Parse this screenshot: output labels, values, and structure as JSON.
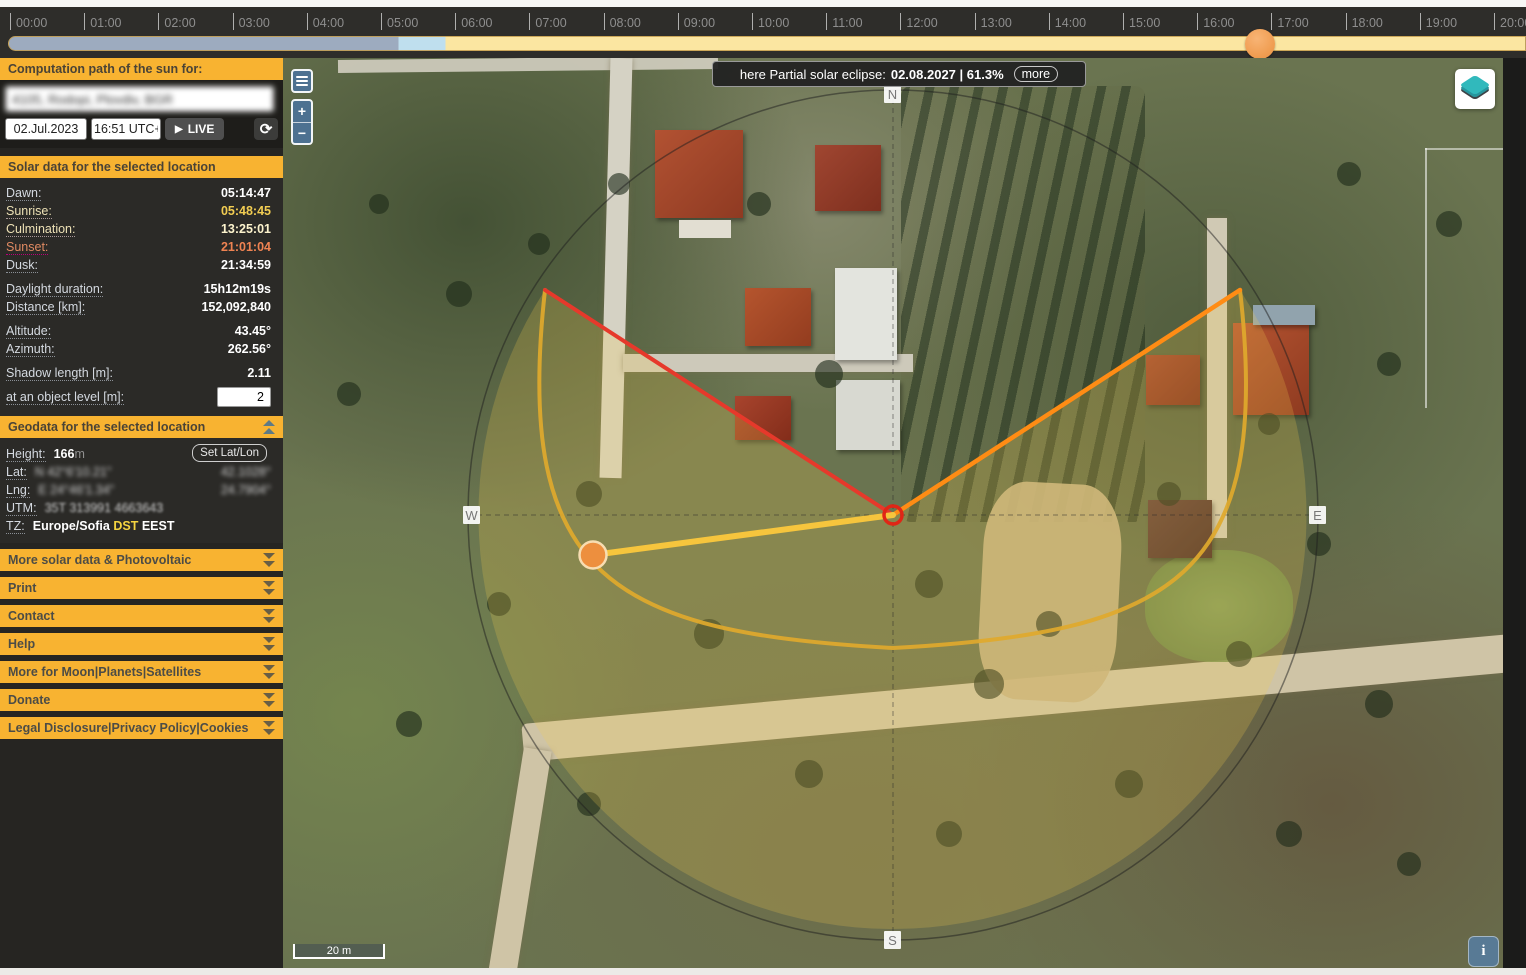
{
  "timeline": {
    "hours": [
      "00:00",
      "01:00",
      "02:00",
      "03:00",
      "04:00",
      "05:00",
      "06:00",
      "07:00",
      "08:00",
      "09:00",
      "10:00",
      "11:00",
      "12:00",
      "13:00",
      "14:00",
      "15:00",
      "16:00",
      "17:00",
      "18:00",
      "19:00",
      "20:00"
    ],
    "handle_hour": 16.85,
    "colors": {
      "night": "#9dabbf",
      "twilight": "#bfdfee",
      "day": "#fbe6a1",
      "handle": "#f09d51"
    }
  },
  "sidebar": {
    "computation_header": "Computation path of the sun for:",
    "location_value": "4105, Rodopi, Plovdiv, BGR",
    "date_value": "02.Jul.2023",
    "time_value": "16:51 UTC+3",
    "live_label": "LIVE",
    "solar_header": "Solar data for the selected location",
    "solar_rows": [
      {
        "label": "Dawn:",
        "value": "05:14:47",
        "style": "dawn"
      },
      {
        "label": "Sunrise:",
        "value": "05:48:45",
        "style": "sunrise"
      },
      {
        "label": "Culmination:",
        "value": "13:25:01",
        "style": "culmination"
      },
      {
        "label": "Sunset:",
        "value": "21:01:04",
        "style": "sunset"
      },
      {
        "label": "Dusk:",
        "value": "21:34:59",
        "style": "dusk"
      },
      {
        "gap": true
      },
      {
        "label": "Daylight duration:",
        "value": "15h12m19s",
        "style": "plain"
      },
      {
        "label": "Distance [km]:",
        "value": "152,092,840",
        "style": "plain"
      },
      {
        "gap": true
      },
      {
        "label": "Altitude:",
        "value": "43.45°",
        "style": "plain"
      },
      {
        "label": "Azimuth:",
        "value": "262.56°",
        "style": "plain"
      },
      {
        "gap": true
      },
      {
        "label": "Shadow length [m]:",
        "value": "2.11",
        "style": "plain"
      },
      {
        "gap": true
      },
      {
        "label": "at an object level [m]:",
        "value": "2",
        "style": "input"
      }
    ],
    "geodata_header": "Geodata for the selected location",
    "geodata": {
      "height_label": "Height:",
      "height_value": "166",
      "height_unit": "m",
      "set_latlon_label": "Set Lat/Lon",
      "lat_label": "Lat:",
      "lat_dms": "N 42°6'10.21\"",
      "lat_dec": "42.1028°",
      "lng_label": "Lng:",
      "lng_dms": "E 24°46'1.34\"",
      "lng_dec": "24.7904°",
      "utm_label": "UTM:",
      "utm_value": "35T 313991 4663643",
      "tz_label": "TZ:",
      "tz_value": "Europe/Sofia",
      "tz_dst": "DST",
      "tz_suffix": "EEST"
    },
    "accordions": [
      "More solar data & Photovoltaic",
      "Print",
      "Contact",
      "Help",
      "More for Moon|Planets|Satellites",
      "Donate",
      "Legal Disclosure|Privacy Policy|Cookies"
    ],
    "accent_color": "#f8b331"
  },
  "map": {
    "banner": {
      "prefix": "here Partial solar eclipse:",
      "bold": "02.08.2027 | 61.3%",
      "more_label": "more"
    },
    "compass": {
      "n": "N",
      "w": "W",
      "e": "E",
      "s": "S"
    },
    "scale_label": "20 m",
    "icons": {
      "play": "▶",
      "refresh": "⟳",
      "info": "i",
      "zoom_in": "+",
      "zoom_out": "−"
    },
    "overlay_colors": {
      "sun_path_arc": "#e0a92c",
      "sunrise_line": "#ff8c14",
      "sunset_line": "#e6392b",
      "current_direction_line": "#f6c53d",
      "sun_disc": "#ed8f3e",
      "center_marker": "#e02616",
      "day_sector_tint": "rgba(248,203,78,0.22)"
    }
  }
}
